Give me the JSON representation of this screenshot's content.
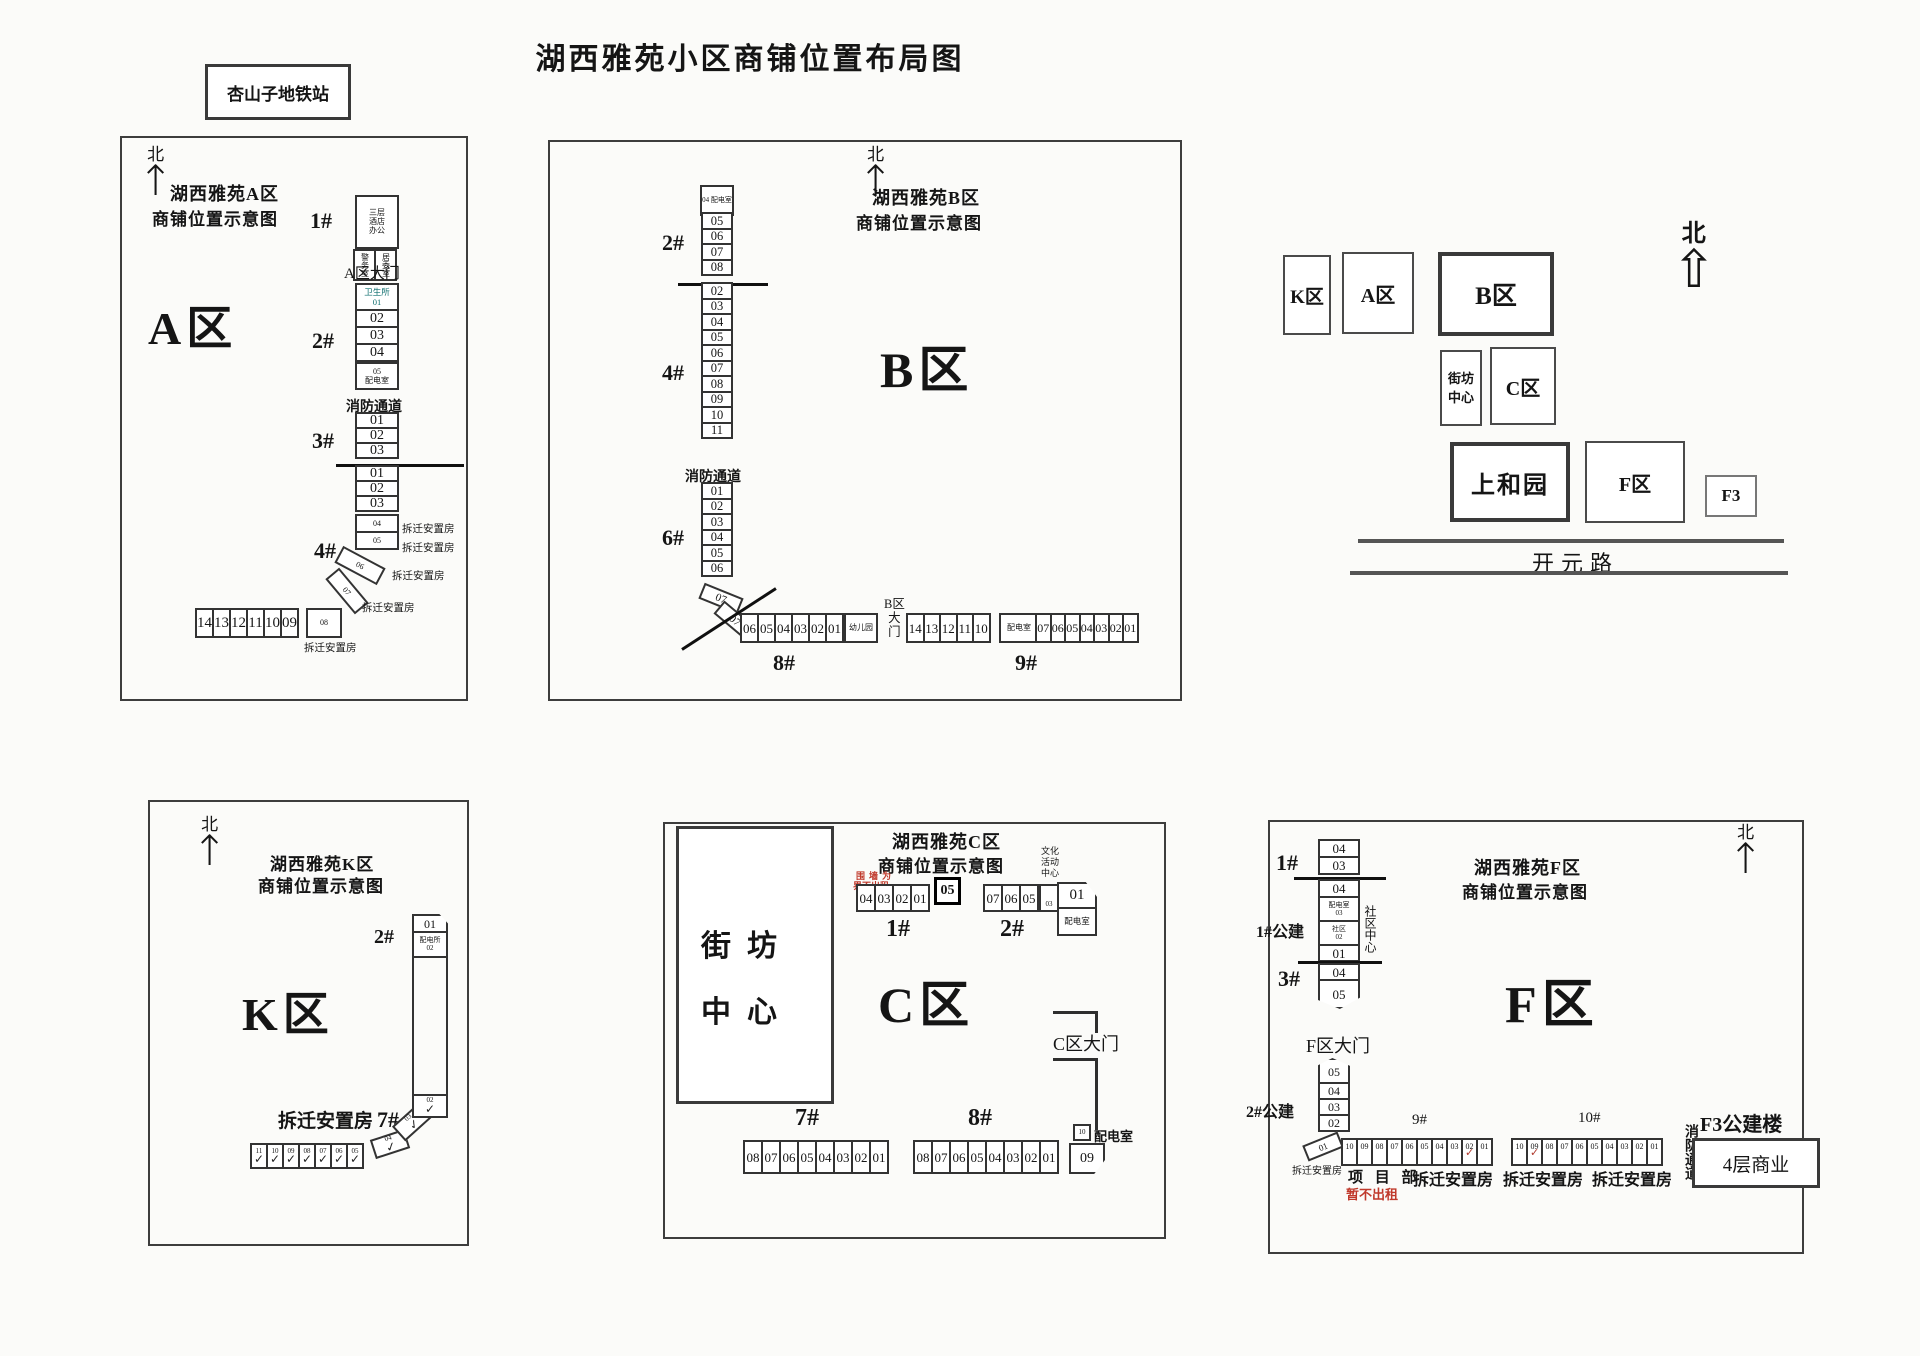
{
  "main_title": "湖西雅苑小区商铺位置布局图",
  "station_label": "杏山子地铁站",
  "panel_a": {
    "title_line1": "湖西雅苑A区",
    "title_line2": "商铺位置示意图",
    "north": "北",
    "arrow": "↑",
    "zone_label": "A区",
    "gate_label": "A区大门",
    "fire_lane": "消防通道",
    "b1": {
      "label": "1#",
      "top_lines": [
        "三层",
        "酒店",
        "办公"
      ],
      "left_cell": "警务室",
      "right_cell": "居委室"
    },
    "b2": {
      "label": "2#",
      "clinic": "卫生所",
      "clinic_no": "01",
      "cells": [
        "02",
        "03",
        "04"
      ],
      "power_no": "05",
      "power": "配电室"
    },
    "b3": {
      "label": "3#",
      "cells": [
        "01",
        "02",
        "03"
      ]
    },
    "b4": {
      "label": "4#",
      "cells": [
        "01",
        "02",
        "03"
      ],
      "side_cells": [
        {
          "no": "04",
          "note": "拆迁安置房"
        },
        {
          "no": "05",
          "note": "拆迁安置房"
        }
      ],
      "diag_cells": [
        {
          "no": "06",
          "note": "拆迁安置房"
        },
        {
          "no": "07",
          "note": "拆迁安置房"
        }
      ]
    },
    "row": {
      "cells": [
        "14",
        "13",
        "12",
        "11",
        "10",
        "09"
      ],
      "last_no": "08",
      "last_note": "拆迁安置房"
    }
  },
  "panel_b": {
    "title_line1": "湖西雅苑B区",
    "title_line2": "商铺位置示意图",
    "north": "北",
    "arrow": "↑",
    "zone_label": "B区",
    "fire_lane": "消防通道",
    "col_top": "04 配电室",
    "b2": {
      "label": "2#",
      "cells": [
        "05",
        "06",
        "07",
        "08"
      ]
    },
    "b4": {
      "label": "4#",
      "cells": [
        "02",
        "03",
        "04",
        "05",
        "06",
        "07",
        "08",
        "09",
        "10",
        "11"
      ]
    },
    "b6": {
      "label": "6#",
      "cells": [
        "01",
        "02",
        "03",
        "04",
        "05",
        "06"
      ],
      "diag": [
        "07",
        "07"
      ]
    },
    "b8": {
      "label": "8#",
      "cells": [
        "06",
        "05",
        "04",
        "03",
        "02",
        "01"
      ],
      "kindergarten": "幼儿园"
    },
    "gate_lines": [
      "B区",
      "大",
      "门"
    ],
    "b9": {
      "label": "9#",
      "cells_left": [
        "14",
        "13",
        "12",
        "11",
        "10"
      ],
      "power": "配电室",
      "cells_right": [
        "07",
        "06",
        "05",
        "04",
        "03",
        "02",
        "01"
      ]
    }
  },
  "overview": {
    "north": "北",
    "arrow": "⇧",
    "k": "K区",
    "a": "A区",
    "b": "B区",
    "jf_line1": "街坊",
    "jf_line2": "中心",
    "c": "C区",
    "sh": "上和园",
    "f": "F区",
    "f3": "F3",
    "road": "开元路"
  },
  "panel_k": {
    "title_line1": "湖西雅苑K区",
    "title_line2": "商铺位置示意图",
    "north": "北",
    "arrow": "↑",
    "zone_label": "K区",
    "b2": {
      "label": "2#",
      "no": "01",
      "power": "配电所",
      "power_no": "02"
    },
    "b7": {
      "label": "拆迁安置房",
      "no_label": "7#",
      "check": "✓",
      "cells": [
        {
          "no": "11"
        },
        {
          "no": "10"
        },
        {
          "no": "09"
        },
        {
          "no": "08"
        },
        {
          "no": "07"
        },
        {
          "no": "06"
        },
        {
          "no": "05"
        }
      ],
      "diag": [
        "04",
        "03",
        "02"
      ]
    }
  },
  "panel_c": {
    "title_line1": "湖西雅苑C区",
    "title_line2": "商铺位置示意图",
    "zone_label": "C区",
    "gate_label": "C区大门",
    "note_line1": "围墙为",
    "note_line2": "界不出租",
    "jf_line1": "街坊",
    "jf_line2": "中心",
    "b1": {
      "label": "1#",
      "cells": [
        "04",
        "03",
        "02",
        "01"
      ],
      "hl": "05"
    },
    "b2": {
      "label": "2#",
      "cells": [
        "07",
        "06",
        "05"
      ],
      "culture_lines": [
        "文化",
        "活动",
        "中心"
      ],
      "culture_no": "03",
      "corner": "01",
      "power": "配电室"
    },
    "b7": {
      "label": "7#",
      "cells": [
        "08",
        "07",
        "06",
        "05",
        "04",
        "03",
        "02",
        "01"
      ]
    },
    "b8": {
      "label": "8#",
      "cells": [
        "08",
        "07",
        "06",
        "05",
        "04",
        "03",
        "02",
        "01"
      ],
      "corner": "09",
      "power_no": "10",
      "power": "配电室"
    }
  },
  "panel_f": {
    "title_line1": "湖西雅苑F区",
    "title_line2": "商铺位置示意图",
    "north": "北",
    "arrow": "↑",
    "zone_label": "F区",
    "gate_label": "F区大门",
    "tick_char": "✓",
    "b1": {
      "label": "1#",
      "cells_a": [
        "04",
        "03"
      ],
      "cell_b": "04"
    },
    "g1": {
      "label": "1#公建",
      "c1_top": "配电室",
      "c1_no": "03",
      "c2_top": "社区",
      "c2_no": "02",
      "side": "社区中心"
    },
    "b3": {
      "label": "3#",
      "first": "01",
      "cell_a": "04",
      "cell_b": "05"
    },
    "g2": {
      "label": "2#公建",
      "cells": [
        "05",
        "04",
        "03",
        "02"
      ],
      "diag": "01",
      "diag_note": "拆迁安置房"
    },
    "row9": {
      "label": "9#",
      "cells": [
        {
          "no": "10"
        },
        {
          "no": "09"
        },
        {
          "no": "08"
        },
        {
          "no": "07"
        },
        {
          "no": "06"
        },
        {
          "no": "05"
        },
        {
          "no": "04"
        },
        {
          "no": "03"
        },
        {
          "no": "02",
          "cls": "ticked"
        },
        {
          "no": "01"
        }
      ]
    },
    "row10": {
      "label": "10#",
      "cells": [
        {
          "no": "10"
        },
        {
          "no": "09",
          "cls": "ticked"
        },
        {
          "no": "08"
        },
        {
          "no": "07"
        },
        {
          "no": "06"
        },
        {
          "no": "05"
        },
        {
          "no": "04"
        },
        {
          "no": "03"
        },
        {
          "no": "02"
        },
        {
          "no": "01"
        }
      ]
    },
    "below": {
      "xmb": "项 目 部",
      "red_note": "暂不出租",
      "resettle1": "拆迁安置房",
      "resettle2": "拆迁安置房",
      "resettle3": "拆迁安置房"
    },
    "fire_v": "消防通道",
    "f3_label": "F3公建楼",
    "f3_box": "4层商业"
  }
}
